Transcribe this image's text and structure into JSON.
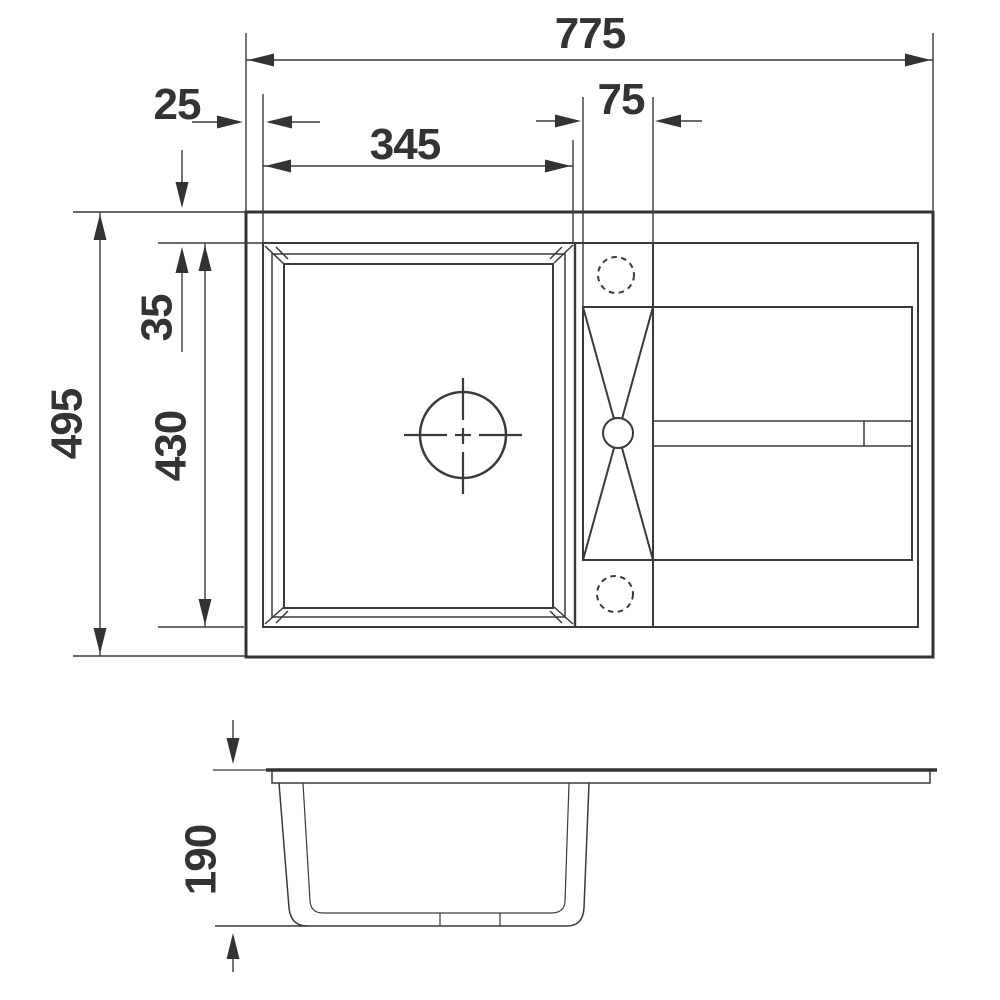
{
  "page": {
    "background": "#ffffff",
    "line_color": "#3a3a3a",
    "thick_line_color": "#333333",
    "text_color": "#333333"
  },
  "drawing": {
    "subject": "sink-with-drainboard-technical-drawing",
    "views": {
      "top_view": "top-view",
      "side_view": "side-view"
    },
    "dimensions": {
      "overall_width": "775",
      "rim_offset_left": "25",
      "bowl_width": "345",
      "tap_panel_width": "75",
      "overall_depth": "495",
      "rim_offset_top": "35",
      "bowl_depth": "430",
      "bowl_height": "190"
    }
  }
}
